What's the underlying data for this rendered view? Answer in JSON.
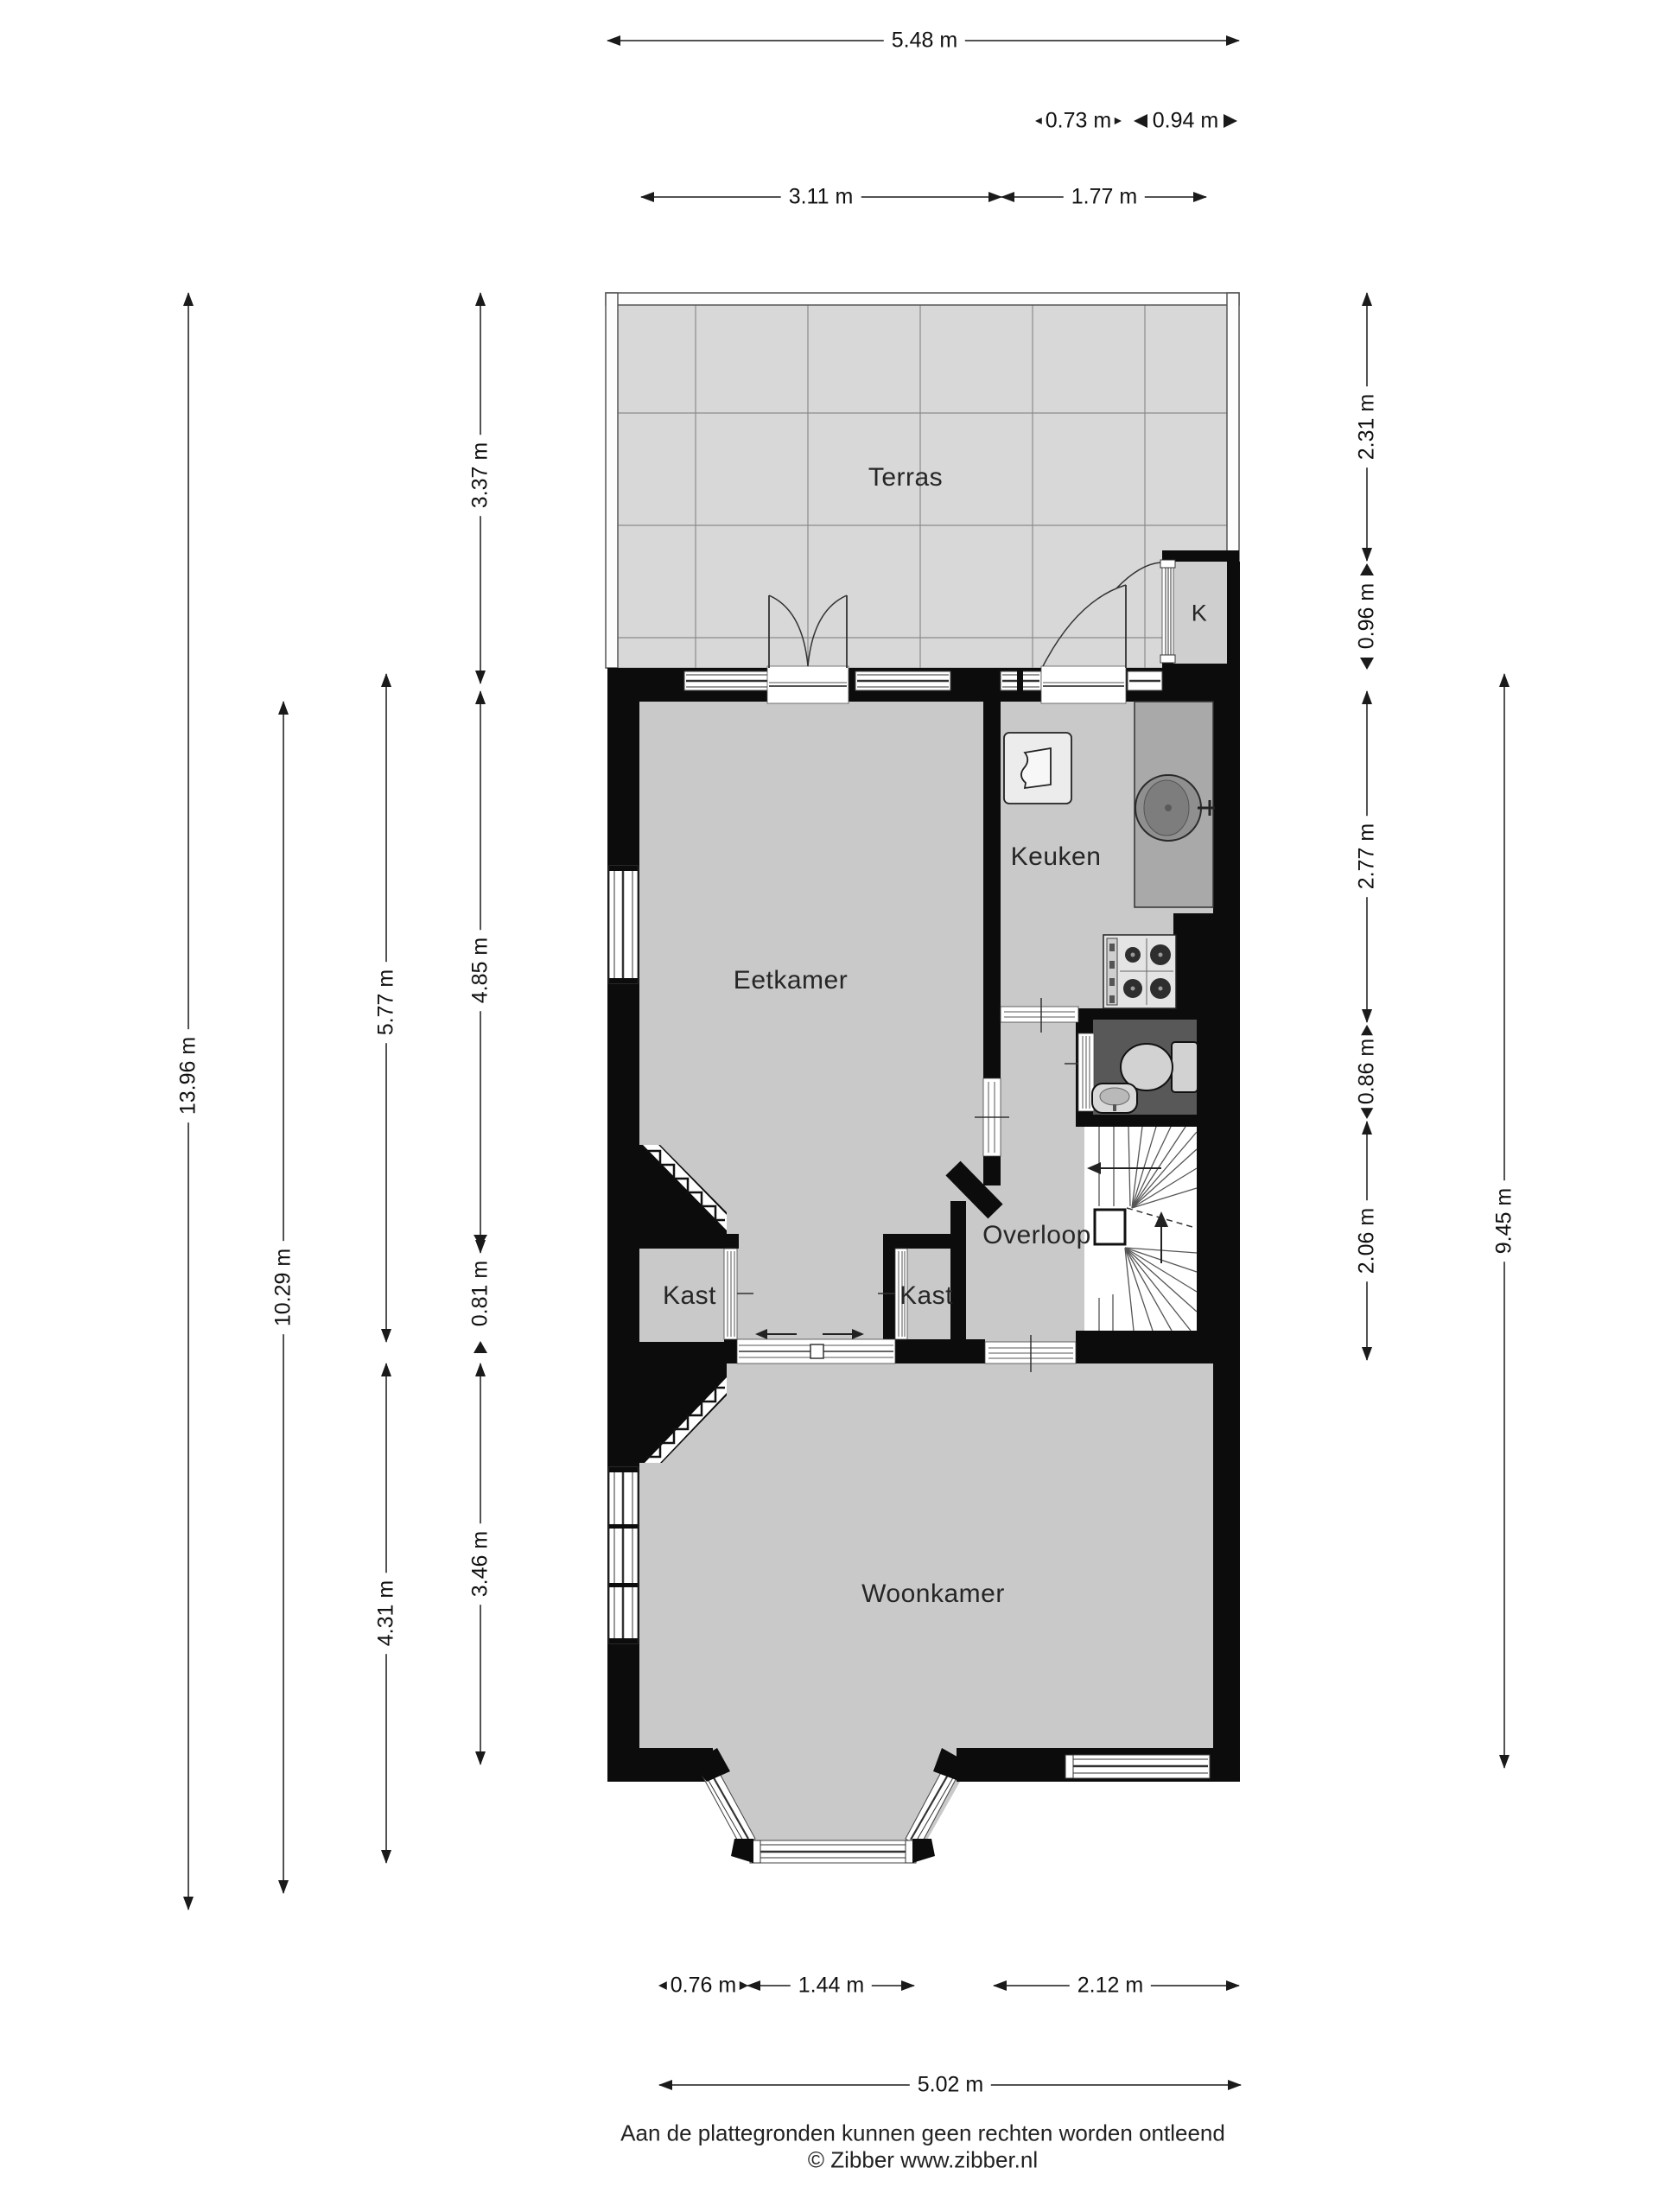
{
  "plan": {
    "rooms": [
      {
        "id": "terras",
        "label": "Terras"
      },
      {
        "id": "keuken",
        "label": "Keuken"
      },
      {
        "id": "eetkamer",
        "label": "Eetkamer"
      },
      {
        "id": "overloop",
        "label": "Overloop"
      },
      {
        "id": "kast-left",
        "label": "Kast"
      },
      {
        "id": "kast-middle",
        "label": "Kast"
      },
      {
        "id": "woonkamer",
        "label": "Woonkamer"
      },
      {
        "id": "closet-k",
        "label": "K"
      }
    ],
    "colors": {
      "wall": "#0c0c0c",
      "room_floor": "#c9c9c9",
      "terrace_floor": "#d8d8d8",
      "terrace_grid": "#8b8b8b",
      "wc_floor": "#585858",
      "counter": "#a9a9a9",
      "window_band": "#ffffff"
    }
  },
  "dimensions": {
    "top": [
      {
        "label": "5.48 m"
      },
      {
        "label": "0.73 m"
      },
      {
        "label": "0.94 m"
      },
      {
        "label": "3.11 m"
      },
      {
        "label": "1.77 m"
      }
    ],
    "left": [
      {
        "label": "13.96 m"
      },
      {
        "label": "10.29 m"
      },
      {
        "label": "5.77 m"
      },
      {
        "label": "4.31 m"
      },
      {
        "label": "3.37 m"
      },
      {
        "label": "4.85 m"
      },
      {
        "label": "0.81 m"
      },
      {
        "label": "3.46 m"
      }
    ],
    "right": [
      {
        "label": "2.31 m"
      },
      {
        "label": "0.96 m"
      },
      {
        "label": "2.77 m"
      },
      {
        "label": "0.86 m"
      },
      {
        "label": "2.06 m"
      },
      {
        "label": "9.45 m"
      }
    ],
    "bottom": [
      {
        "label": "0.76 m"
      },
      {
        "label": "1.44 m"
      },
      {
        "label": "2.12 m"
      },
      {
        "label": "5.02 m"
      }
    ]
  },
  "footer": {
    "disclaimer": "Aan de plattegronden kunnen geen rechten worden ontleend",
    "credit": "© Zibber www.zibber.nl"
  }
}
